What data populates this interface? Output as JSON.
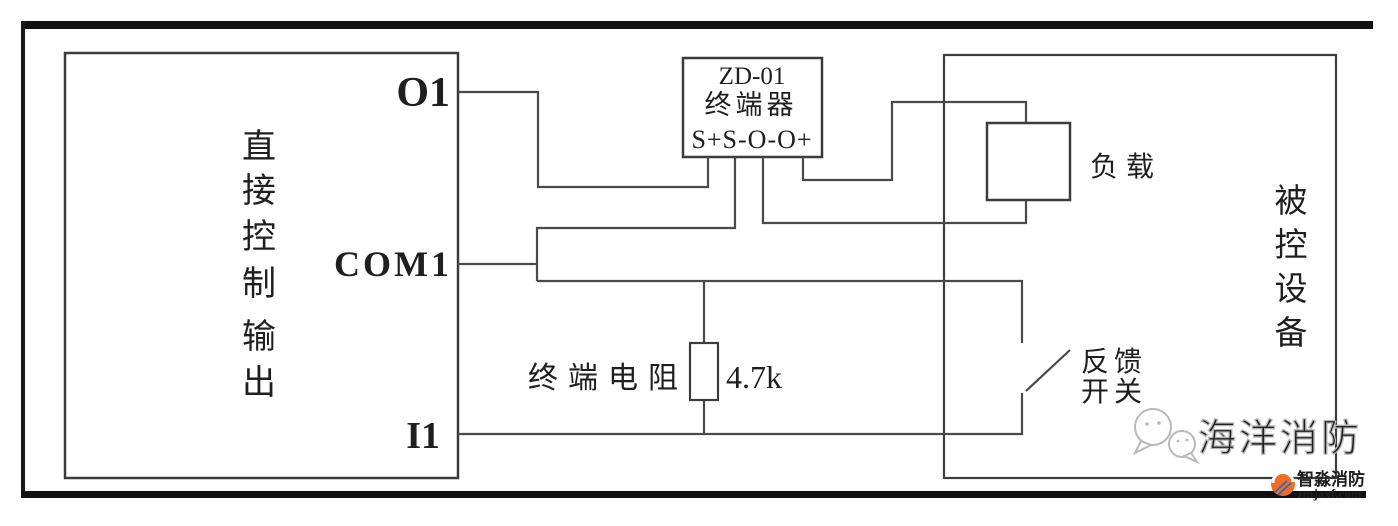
{
  "left_box": {
    "title": "直接控制输出",
    "chars": [
      "直",
      "接",
      "控",
      "制",
      "输",
      "出"
    ],
    "terminals": {
      "o1": "O1",
      "com1": "COM1",
      "i1": "I1"
    }
  },
  "terminator_box": {
    "model": "ZD-01",
    "name": "终端器",
    "pins": "S+S-O-O+"
  },
  "load": {
    "label": "负载"
  },
  "resistor": {
    "label": "终端电阻",
    "value": "4.7k"
  },
  "feedback_switch": {
    "line1": "反馈",
    "line2": "开关"
  },
  "controlled_box": {
    "title": "被控设备",
    "chars": [
      "被",
      "控",
      "设",
      "备"
    ]
  },
  "watermarks": {
    "center_text": "海洋消防",
    "logo_name": "智淼消防",
    "logo_url": "zmjaxf.com"
  },
  "colors": {
    "wire": "#4a4a4a",
    "frame": "#111111",
    "watermark_gray": "#b4b4b4",
    "logo_orange": "#f26b26",
    "logo_red": "#8e1c1c",
    "logo_blue": "#2b6cb0"
  }
}
